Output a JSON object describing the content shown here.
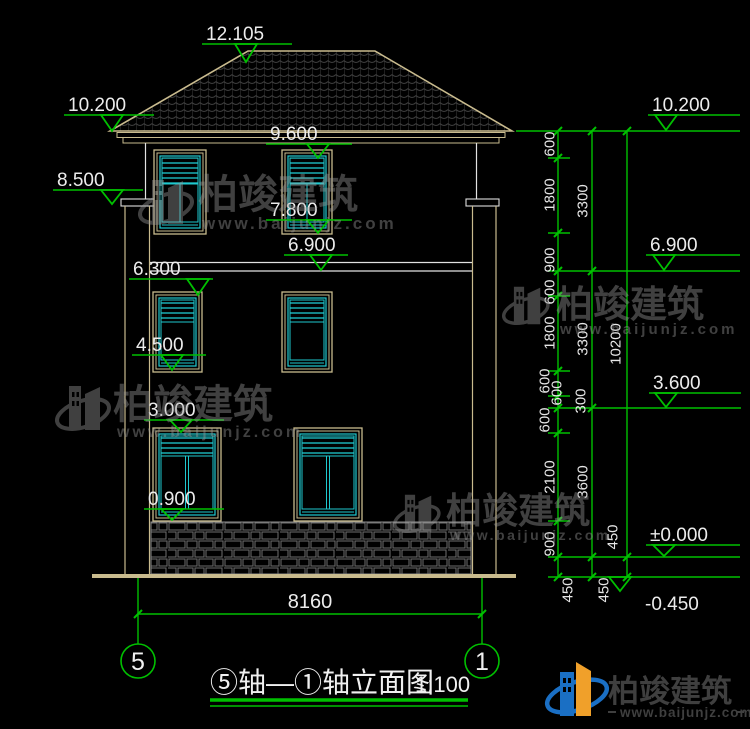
{
  "drawing": {
    "title": "⑤轴—①轴立面图",
    "scale_label": "1:100",
    "axis_bubble_left": "5",
    "axis_bubble_right": "1",
    "ground_width_dim": "8160",
    "levels_left": [
      "12.105",
      "10.200",
      "8.500",
      "9.600",
      "7.800",
      "6.900",
      "6.300",
      "4.500",
      "3.000",
      "0.900"
    ],
    "levels_right": [
      "10.200",
      "6.900",
      "3.600",
      "±0.000",
      "-0.450"
    ],
    "dim_chain_inner": [
      "600",
      "1800",
      "900",
      "600",
      "1800",
      "600",
      "600",
      "600",
      "2100",
      "900",
      "450"
    ],
    "dim_chain_middle": [
      "3300",
      "3300",
      "300",
      "3600",
      "450"
    ],
    "dim_chain_outer": [
      "10200",
      "450"
    ]
  },
  "watermark": {
    "brand": "柏竣建筑",
    "site": "www.baijunjz.com"
  },
  "brand_footer": {
    "brand": "柏竣建筑",
    "site": "www.baijunjz.com"
  },
  "colors": {
    "background": "#000000",
    "line_tan": "#C9BB8E",
    "line_white": "#E2E2E2",
    "accent_cyan": "#1EC8CE",
    "dim_green": "#00C000",
    "text_white": "#ECECEC",
    "brand_blue": "#1A6FC4",
    "brand_orange": "#F0A02A"
  }
}
